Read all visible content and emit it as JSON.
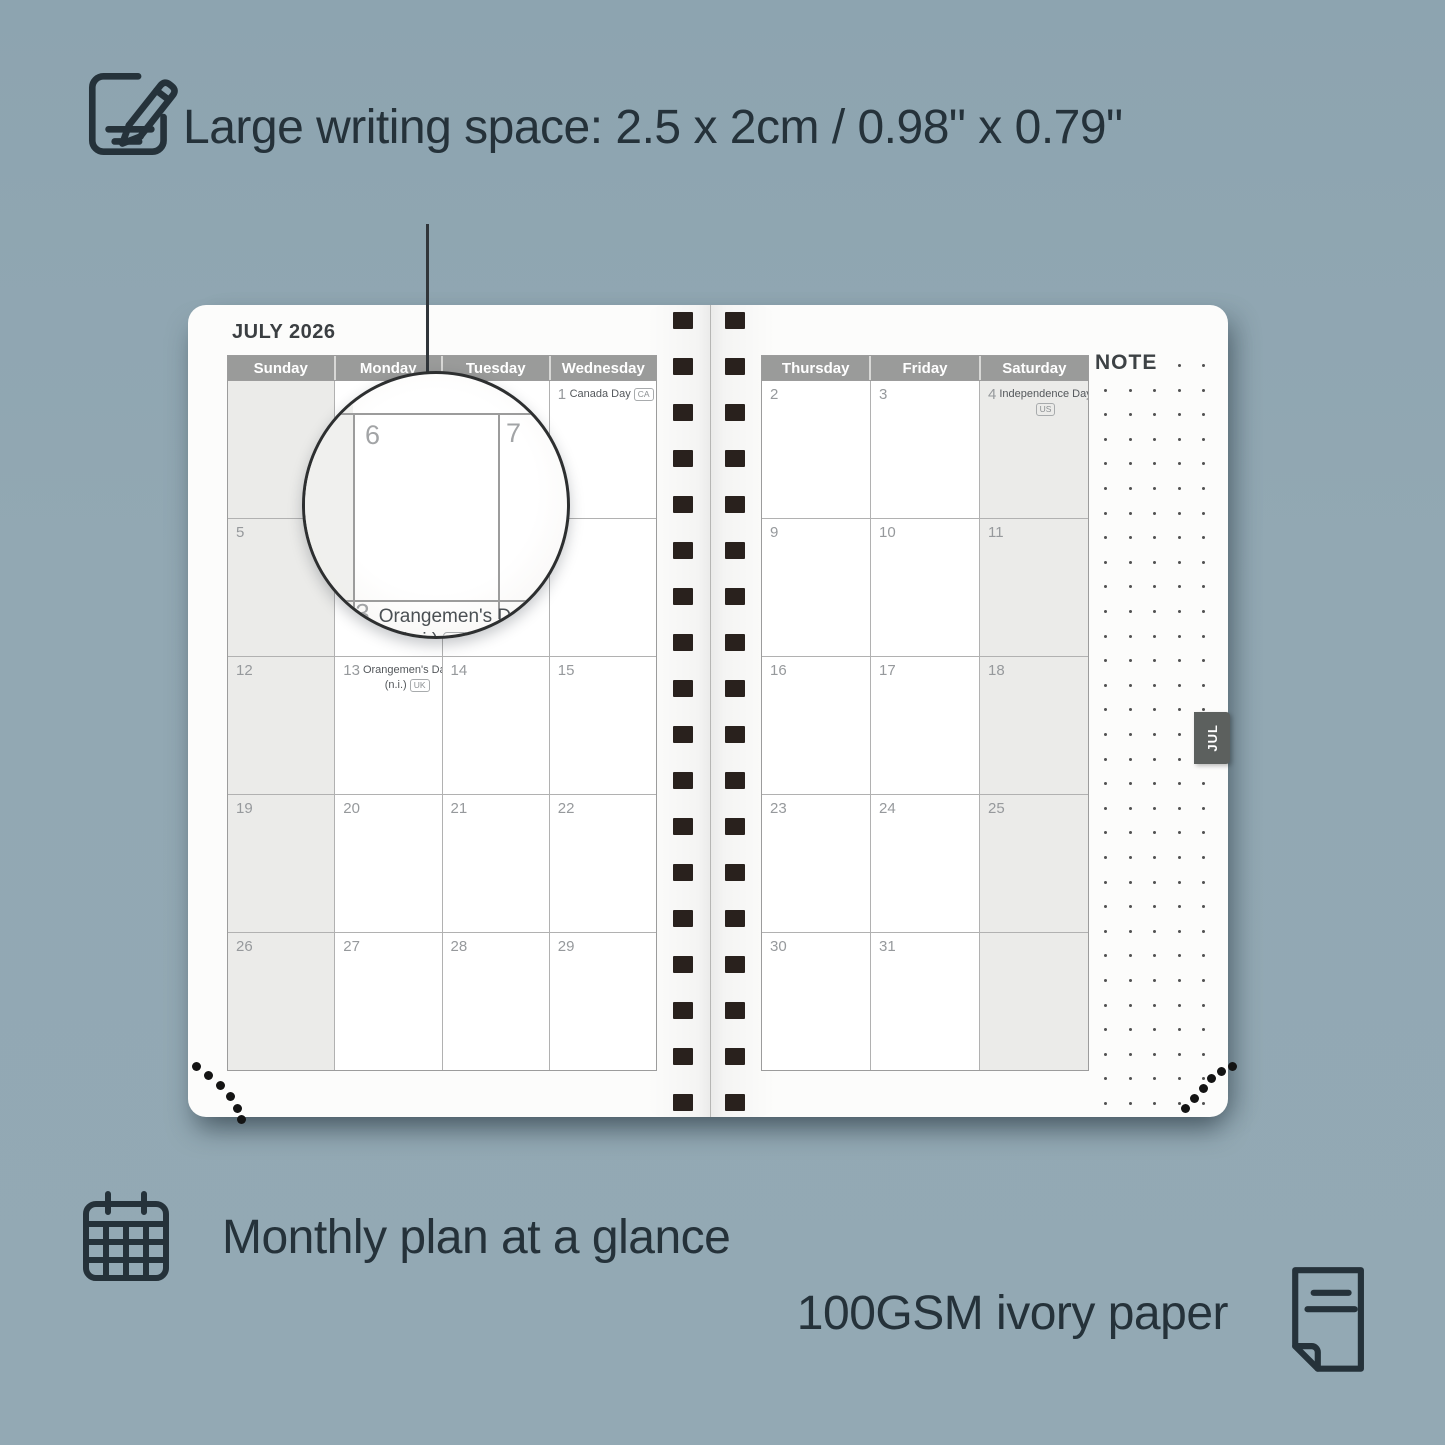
{
  "features": {
    "writing_space": "Large writing space: 2.5 x 2cm / 0.98\" x 0.79\"",
    "monthly_plan": "Monthly plan at a glance",
    "paper": "100GSM ivory paper"
  },
  "planner": {
    "month_title": "JULY 2026",
    "note_label": "NOTE",
    "month_tab": "JUL",
    "left_page": {
      "day_headers": [
        "Sunday",
        "Monday",
        "Tuesday",
        "Wednesday"
      ],
      "weekend_column": 0,
      "rows": [
        [
          {
            "date": ""
          },
          {
            "date": ""
          },
          {
            "date": ""
          },
          {
            "date": "1",
            "holiday": "Canada Day",
            "badge": "CA"
          }
        ],
        [
          {
            "date": "5"
          },
          {
            "date": "6"
          },
          {
            "date": "7"
          },
          {
            "date": "8"
          }
        ],
        [
          {
            "date": "12"
          },
          {
            "date": "13",
            "holiday": "Orangemen's Day",
            "holiday_sub": "(n.i.)",
            "badge": "UK"
          },
          {
            "date": "14"
          },
          {
            "date": "15"
          }
        ],
        [
          {
            "date": "19"
          },
          {
            "date": "20"
          },
          {
            "date": "21"
          },
          {
            "date": "22"
          }
        ],
        [
          {
            "date": "26"
          },
          {
            "date": "27"
          },
          {
            "date": "28"
          },
          {
            "date": "29"
          }
        ]
      ]
    },
    "right_page": {
      "day_headers": [
        "Thursday",
        "Friday",
        "Saturday"
      ],
      "weekend_column": 2,
      "rows": [
        [
          {
            "date": "2"
          },
          {
            "date": "3"
          },
          {
            "date": "4",
            "holiday": "Independence Day",
            "badge": "US"
          }
        ],
        [
          {
            "date": "9"
          },
          {
            "date": "10"
          },
          {
            "date": "11"
          }
        ],
        [
          {
            "date": "16"
          },
          {
            "date": "17"
          },
          {
            "date": "18"
          }
        ],
        [
          {
            "date": "23"
          },
          {
            "date": "24"
          },
          {
            "date": "25"
          }
        ],
        [
          {
            "date": "30"
          },
          {
            "date": "31"
          },
          {
            "date": ""
          }
        ]
      ]
    }
  },
  "magnifier": {
    "day_left": "6",
    "day_right": "7",
    "date": "13",
    "holiday": "Orangemen's Day",
    "holiday_sub": "(n.i.)",
    "badge": "UK"
  },
  "colors": {
    "background": "#92a8b3",
    "ink": "#25323a",
    "header_bar": "#9a9b9a",
    "weekend_fill": "#ebebe9",
    "tab_fill": "#5c605e",
    "binding": "#29211d"
  }
}
